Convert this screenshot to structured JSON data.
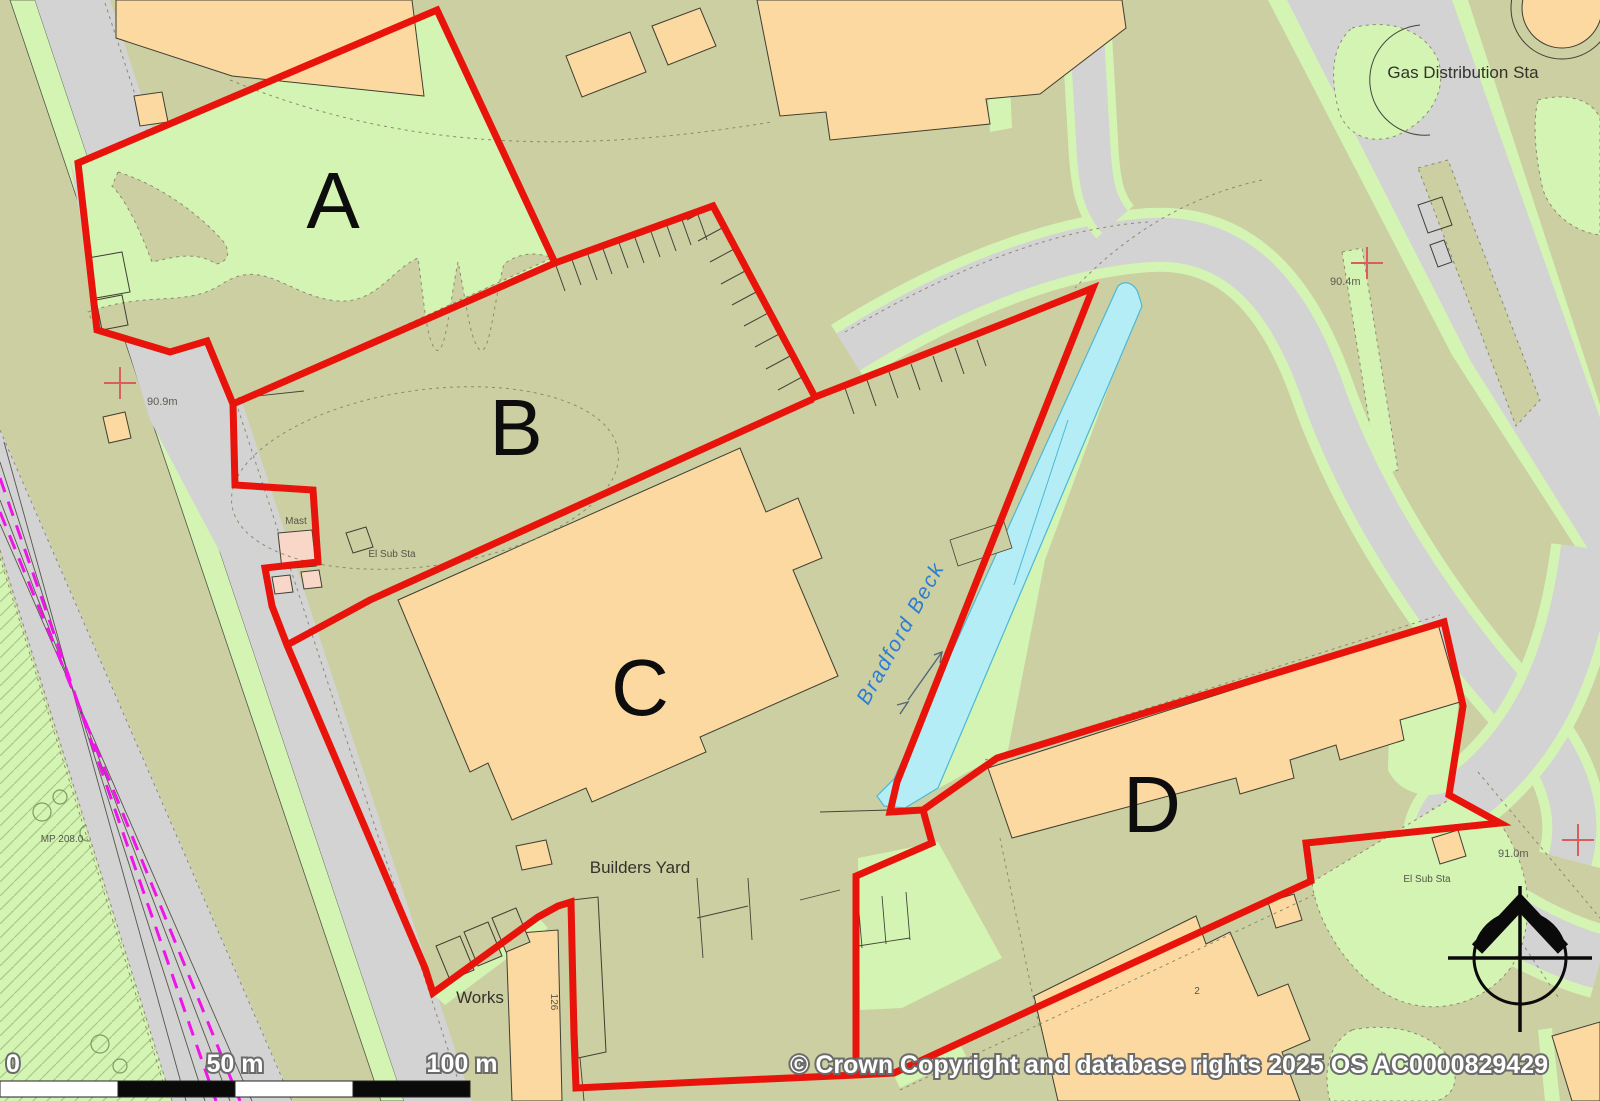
{
  "parcels": {
    "a": "A",
    "b": "B",
    "c": "C",
    "d": "D"
  },
  "places": {
    "gas_distribution_sta": "Gas Distribution Sta",
    "bradford_beck": "Bradford Beck",
    "builders_yard": "Builders Yard",
    "works": "Works",
    "mast": "Mast",
    "el_sub_sta_north": "El Sub Sta",
    "el_sub_sta_southeast": "El Sub Sta",
    "milepost": "MP 208.0",
    "building_number_126": "126",
    "building_number_2": "2"
  },
  "spot_heights": {
    "west": "90.9m",
    "northeast": "90.4m",
    "southeast": "91.0m"
  },
  "scale_bar": {
    "zero": "0",
    "fifty": "50 m",
    "hundred": "100 m"
  },
  "copyright": "© Crown Copyright and database rights 2025 OS AC0000829429",
  "colors": {
    "land": "#cbcfa1",
    "grass": "#d3f4b3",
    "building_orange": "#fbd9a1",
    "building_pink": "#f8d7c8",
    "road_gray": "#d3d3d3",
    "water_cyan": "#b5edf6",
    "boundary_red": "#e8130a",
    "railway_magenta": "#ef14e8",
    "grid_cross_red": "#d95f5f"
  }
}
